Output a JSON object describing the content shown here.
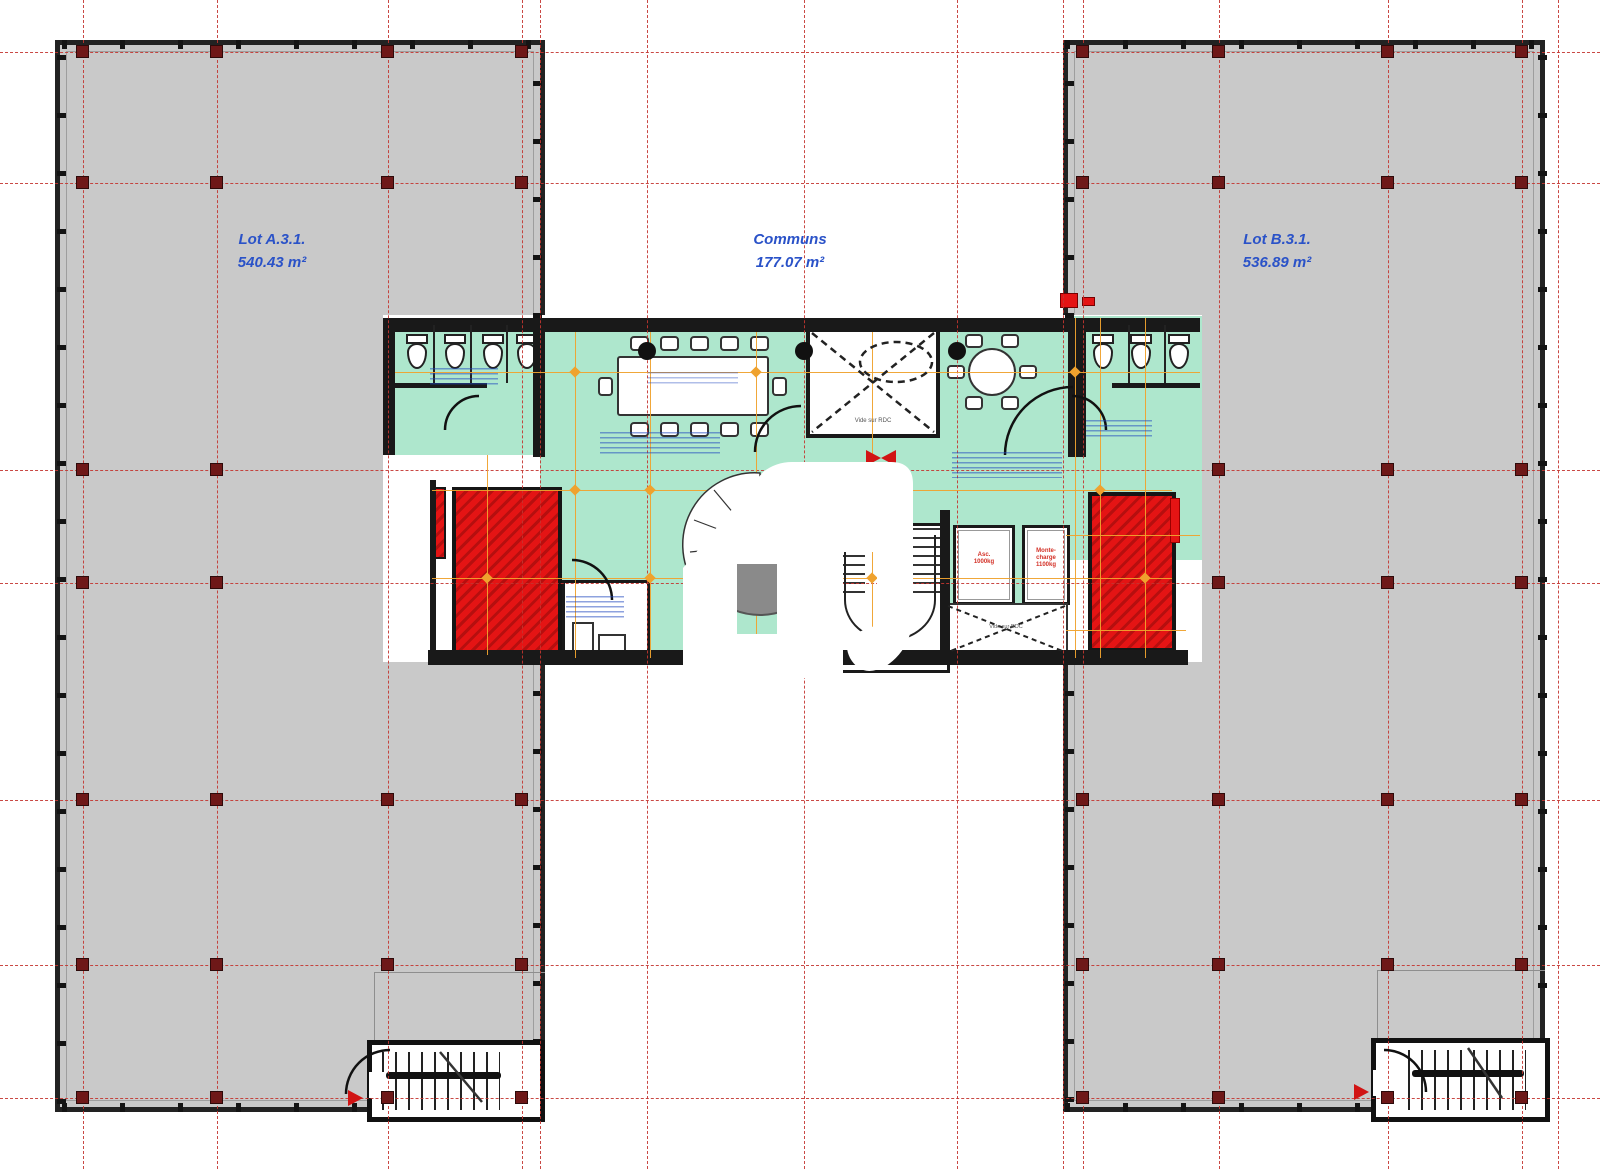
{
  "plan": {
    "lots": [
      {
        "id": "lot-a",
        "name": "Lot A.3.1.",
        "area": "540.43 m²"
      },
      {
        "id": "communs",
        "name": "Communs",
        "area": "177.07 m²"
      },
      {
        "id": "lot-b",
        "name": "Lot B.3.1.",
        "area": "536.89 m²"
      }
    ],
    "annotations": {
      "void_upper": "Vide sur RDC",
      "void_lower": "Vide sur RDC",
      "elevator_line1": "Asc.",
      "elevator_line2": "1000kg",
      "freight_line1": "Monte-",
      "freight_line2": "charge",
      "freight_line3": "1100kg"
    },
    "colors": {
      "wing_fill": "#c9c9c9",
      "wall": "#191919",
      "grid_red": "#c43530",
      "column_red": "#6e1818",
      "floor_green": "#aee7cd",
      "shaft_red": "#e41414",
      "orange": "#efa22e",
      "label_blue": "#2a52c8"
    }
  }
}
